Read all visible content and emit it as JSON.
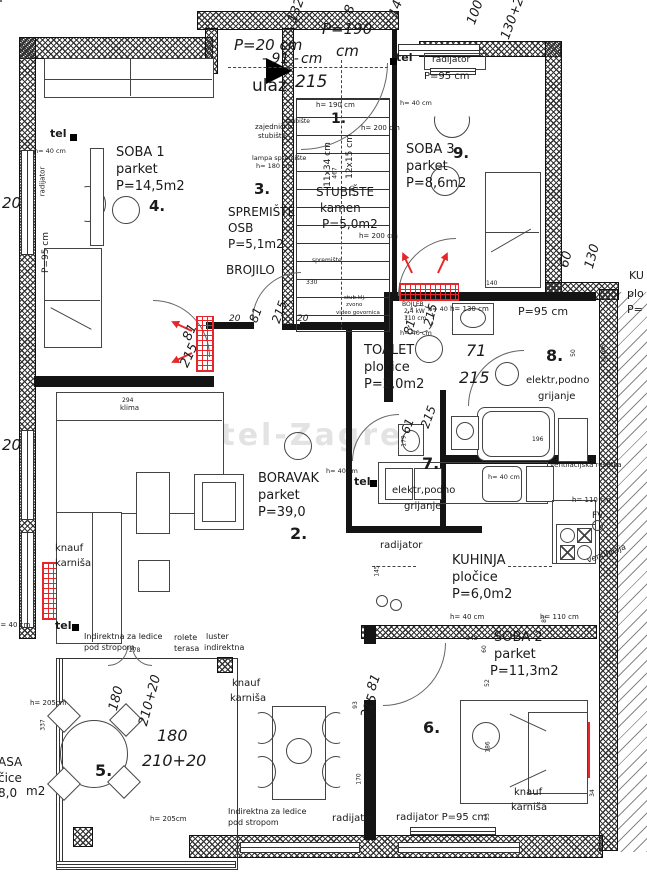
{
  "colors": {
    "radiator_red": "#e8262a",
    "wall_black": "#141414"
  },
  "watermark": {
    "text": "Kastel-Zagreb"
  },
  "labels": [
    {
      "t": "P=20 cm",
      "x": 234,
      "y": 38,
      "s": 15,
      "i": 1,
      "n": "dim-parapet-entry"
    },
    {
      "t": "P=190",
      "x": 322,
      "y": 22,
      "s": 15,
      "i": 1,
      "n": "dim-parapet"
    },
    {
      "t": "cm",
      "x": 336,
      "y": 44,
      "s": 15,
      "i": 1
    },
    {
      "t": "- 91 -",
      "x": 262,
      "y": 52,
      "s": 14,
      "i": 1,
      "n": "dim-door-width"
    },
    {
      "t": "cm",
      "x": 301,
      "y": 52,
      "s": 14,
      "i": 1
    },
    {
      "t": "ulaz",
      "x": 252,
      "y": 78,
      "s": 17,
      "n": "entrance-label"
    },
    {
      "t": "215",
      "x": 295,
      "y": 74,
      "s": 17,
      "i": 1
    },
    {
      "t": "1.",
      "x": 331,
      "y": 112,
      "s": 14,
      "b": 1,
      "n": "room-number-1"
    },
    {
      "t": "zajedničko",
      "x": 255,
      "y": 124,
      "s": 7
    },
    {
      "t": "stubište",
      "x": 258,
      "y": 133,
      "s": 7
    },
    {
      "t": "stubište",
      "x": 286,
      "y": 119,
      "s": 6
    },
    {
      "t": "h= 190 cm",
      "x": 316,
      "y": 102,
      "s": 7
    },
    {
      "t": "h= 200 cm",
      "x": 361,
      "y": 125,
      "s": 7
    },
    {
      "t": "h= 200 cm",
      "x": 359,
      "y": 233,
      "s": 7
    },
    {
      "t": "lampa spremište",
      "x": 252,
      "y": 155,
      "s": 6.5
    },
    {
      "t": "h= 180 cm",
      "x": 256,
      "y": 163,
      "s": 6.5
    },
    {
      "t": "3.",
      "x": 254,
      "y": 182,
      "s": 15,
      "b": 1,
      "n": "room-number-3"
    },
    {
      "t": "SPREMIŠTE",
      "x": 228,
      "y": 206,
      "s": 12,
      "n": "room-name-spremiste"
    },
    {
      "t": "OSB",
      "x": 228,
      "y": 222,
      "s": 12
    },
    {
      "t": "P=5,1m2",
      "x": 228,
      "y": 238,
      "s": 12
    },
    {
      "t": "BROJILO",
      "x": 226,
      "y": 264,
      "s": 12,
      "n": "meter-label"
    },
    {
      "t": "STUBIŠTE",
      "x": 316,
      "y": 186,
      "s": 12,
      "n": "room-name-stubiste"
    },
    {
      "t": "kamen",
      "x": 320,
      "y": 202,
      "s": 12
    },
    {
      "t": "P=5,0m2",
      "x": 322,
      "y": 218,
      "s": 12
    },
    {
      "t": "spremište",
      "x": 312,
      "y": 258,
      "s": 6
    },
    {
      "t": "330",
      "x": 306,
      "y": 280,
      "s": 6
    },
    {
      "t": "11x34 cm",
      "x": 306,
      "y": 160,
      "s": 9,
      "r": -90
    },
    {
      "t": "12x15 cm",
      "x": 328,
      "y": 152,
      "s": 9,
      "r": -90
    },
    {
      "t": "467",
      "x": 330,
      "y": 170,
      "s": 6,
      "r": -90
    },
    {
      "t": "170",
      "x": 348,
      "y": 188,
      "s": 6,
      "r": -90
    },
    {
      "t": "132",
      "x": 284,
      "y": 4,
      "s": 13,
      "i": 1,
      "r": -70
    },
    {
      "t": "8",
      "x": 346,
      "y": 3,
      "s": 13,
      "i": 1,
      "r": -70
    },
    {
      "t": "14",
      "x": 388,
      "y": 2,
      "s": 13,
      "i": 1,
      "r": -70
    },
    {
      "t": "100",
      "x": 463,
      "y": 6,
      "s": 13,
      "i": 1,
      "r": -70
    },
    {
      "t": "130+20",
      "x": 488,
      "y": 8,
      "s": 13,
      "i": 1,
      "r": -70
    },
    {
      "t": "tel",
      "x": 50,
      "y": 128,
      "s": 11,
      "b": 1,
      "n": "tel-label"
    },
    {
      "t": "h= 40 cm",
      "x": 34,
      "y": 148,
      "s": 6.5
    },
    {
      "t": "radijator",
      "x": 28,
      "y": 178,
      "s": 7,
      "r": -90,
      "n": "radiator-label"
    },
    {
      "t": "P=95 cm",
      "x": 26,
      "y": 248,
      "s": 9,
      "r": -90
    },
    {
      "t": "SOBA 1",
      "x": 116,
      "y": 146,
      "s": 13,
      "n": "room-name-soba1"
    },
    {
      "t": "parket",
      "x": 116,
      "y": 163,
      "s": 13
    },
    {
      "t": "P=14,5m2",
      "x": 116,
      "y": 180,
      "s": 13
    },
    {
      "t": "4.",
      "x": 149,
      "y": 199,
      "s": 15,
      "b": 1,
      "n": "room-number-4"
    },
    {
      "t": "20",
      "x": 2,
      "y": 196,
      "s": 15,
      "i": 1
    },
    {
      "t": "20",
      "x": 2,
      "y": 438,
      "s": 15,
      "i": 1
    },
    {
      "t": "tel",
      "x": 396,
      "y": 52,
      "s": 11,
      "b": 1,
      "n": "tel-label"
    },
    {
      "t": "radijator",
      "x": 432,
      "y": 56,
      "s": 9,
      "n": "radiator-label"
    },
    {
      "t": "P=95 cm",
      "x": 424,
      "y": 72,
      "s": 10
    },
    {
      "t": "h= 40 cm",
      "x": 400,
      "y": 100,
      "s": 6.5
    },
    {
      "t": "SOBA 3",
      "x": 406,
      "y": 143,
      "s": 13,
      "n": "room-name-soba3"
    },
    {
      "t": "parket",
      "x": 406,
      "y": 160,
      "s": 13
    },
    {
      "t": "P=8,6m2",
      "x": 406,
      "y": 177,
      "s": 13
    },
    {
      "t": "9.",
      "x": 453,
      "y": 146,
      "s": 15,
      "b": 1,
      "n": "room-number-9"
    },
    {
      "t": "60",
      "x": 558,
      "y": 253,
      "s": 13,
      "i": 1,
      "r": -75
    },
    {
      "t": "130",
      "x": 580,
      "y": 250,
      "s": 13,
      "i": 1,
      "r": -75
    },
    {
      "t": "140",
      "x": 486,
      "y": 281,
      "s": 6
    },
    {
      "t": "h= 40",
      "x": 428,
      "y": 306,
      "s": 6.5
    },
    {
      "t": "KU",
      "x": 629,
      "y": 270,
      "s": 11,
      "n": "cut-room-name"
    },
    {
      "t": "plo",
      "x": 627,
      "y": 288,
      "s": 11
    },
    {
      "t": "P=",
      "x": 627,
      "y": 304,
      "s": 11
    },
    {
      "t": "stub.klj.",
      "x": 344,
      "y": 296,
      "s": 5.5
    },
    {
      "t": "zvono",
      "x": 346,
      "y": 303,
      "s": 5.5
    },
    {
      "t": "video govornica",
      "x": 336,
      "y": 311,
      "s": 5.5
    },
    {
      "t": "20",
      "x": 229,
      "y": 315,
      "s": 9,
      "i": 1
    },
    {
      "t": "81",
      "x": 248,
      "y": 309,
      "s": 12,
      "i": 1,
      "r": -70
    },
    {
      "t": "215",
      "x": 268,
      "y": 306,
      "s": 12,
      "i": 1,
      "r": -70
    },
    {
      "t": "20",
      "x": 297,
      "y": 315,
      "s": 9,
      "i": 1
    },
    {
      "t": "81",
      "x": 182,
      "y": 326,
      "s": 13,
      "i": 1,
      "r": -65
    },
    {
      "t": "215",
      "x": 177,
      "y": 349,
      "s": 13,
      "i": 1,
      "r": -65
    },
    {
      "t": "TOALET",
      "x": 364,
      "y": 344,
      "s": 13,
      "n": "room-name-toalet"
    },
    {
      "t": "pločice",
      "x": 364,
      "y": 361,
      "s": 13
    },
    {
      "t": "P=2,0m2",
      "x": 364,
      "y": 378,
      "s": 13
    },
    {
      "t": "71",
      "x": 466,
      "y": 343,
      "s": 16,
      "i": 1
    },
    {
      "t": "215",
      "x": 459,
      "y": 370,
      "s": 16,
      "i": 1
    },
    {
      "t": "81",
      "x": 402,
      "y": 321,
      "s": 12,
      "i": 1,
      "r": -75
    },
    {
      "t": "215",
      "x": 419,
      "y": 309,
      "s": 12,
      "i": 1,
      "r": -75
    },
    {
      "t": "8.",
      "x": 546,
      "y": 348,
      "s": 16,
      "b": 1,
      "n": "room-number-8"
    },
    {
      "t": "50",
      "x": 570,
      "y": 350,
      "s": 6,
      "r": -90
    },
    {
      "t": "el.trlo",
      "x": 596,
      "y": 350,
      "s": 6,
      "r": -90
    },
    {
      "t": "elektr,podno",
      "x": 526,
      "y": 376,
      "s": 10
    },
    {
      "t": "grijanje",
      "x": 538,
      "y": 392,
      "s": 10
    },
    {
      "t": "BOJLER",
      "x": 402,
      "y": 302,
      "s": 6,
      "n": "boiler-label"
    },
    {
      "t": "2,4 kW",
      "x": 404,
      "y": 309,
      "s": 6
    },
    {
      "t": "110 cm",
      "x": 404,
      "y": 316,
      "s": 6
    },
    {
      "t": "h= 40 cm",
      "x": 400,
      "y": 330,
      "s": 6.5
    },
    {
      "t": "h= 130 cm",
      "x": 450,
      "y": 306,
      "s": 7
    },
    {
      "t": "P=95 cm",
      "x": 518,
      "y": 306,
      "s": 11
    },
    {
      "t": "196",
      "x": 532,
      "y": 437,
      "s": 6
    },
    {
      "t": "61",
      "x": 400,
      "y": 420,
      "s": 12,
      "i": 1,
      "r": -70
    },
    {
      "t": "215",
      "x": 417,
      "y": 411,
      "s": 12,
      "i": 1,
      "r": -70
    },
    {
      "t": "179",
      "x": 399,
      "y": 438,
      "s": 6,
      "r": -90
    },
    {
      "t": "7.",
      "x": 422,
      "y": 456,
      "s": 16,
      "b": 1,
      "n": "room-number-7"
    },
    {
      "t": "tel",
      "x": 354,
      "y": 476,
      "s": 11,
      "b": 1,
      "n": "tel-label"
    },
    {
      "t": "h= 40 cm",
      "x": 326,
      "y": 468,
      "s": 6.5
    },
    {
      "t": "elektr,podno",
      "x": 392,
      "y": 486,
      "s": 10
    },
    {
      "t": "grijanje",
      "x": 404,
      "y": 502,
      "s": 10
    },
    {
      "t": "294",
      "x": 122,
      "y": 398,
      "s": 6
    },
    {
      "t": "klima",
      "x": 120,
      "y": 405,
      "s": 7,
      "n": "ac-label"
    },
    {
      "t": "BORAVAK",
      "x": 258,
      "y": 472,
      "s": 13,
      "n": "room-name-boravak"
    },
    {
      "t": "parket",
      "x": 258,
      "y": 489,
      "s": 13
    },
    {
      "t": "P=39,0",
      "x": 258,
      "y": 506,
      "s": 13
    },
    {
      "t": "2.",
      "x": 290,
      "y": 526,
      "s": 16,
      "b": 1,
      "n": "room-number-2"
    },
    {
      "t": "ventilacijska rešetka",
      "x": 550,
      "y": 462,
      "s": 7
    },
    {
      "t": "FV",
      "x": 592,
      "y": 512,
      "s": 9
    },
    {
      "t": "h= 110 cm",
      "x": 572,
      "y": 497,
      "s": 7
    },
    {
      "t": "radijator",
      "x": 380,
      "y": 541,
      "s": 10,
      "n": "radiator-label"
    },
    {
      "t": "KUHINJA",
      "x": 452,
      "y": 554,
      "s": 13,
      "n": "room-name-kuhinja"
    },
    {
      "t": "pločice",
      "x": 452,
      "y": 571,
      "s": 13
    },
    {
      "t": "P=6,0m2",
      "x": 452,
      "y": 588,
      "s": 13
    },
    {
      "t": "ventilacija",
      "x": 586,
      "y": 550,
      "s": 8,
      "r": -20
    },
    {
      "t": "h= 40 cm",
      "x": 450,
      "y": 614,
      "s": 7
    },
    {
      "t": "h= 110 cm",
      "x": 540,
      "y": 614,
      "s": 7
    },
    {
      "t": "h= 40 cm",
      "x": 488,
      "y": 474,
      "s": 6.5
    },
    {
      "t": "145",
      "x": 372,
      "y": 568,
      "s": 6,
      "r": -90
    },
    {
      "t": "knauf",
      "x": 55,
      "y": 544,
      "s": 10
    },
    {
      "t": "karniša",
      "x": 55,
      "y": 559,
      "s": 10
    },
    {
      "t": "tel",
      "x": 55,
      "y": 620,
      "s": 11,
      "b": 1,
      "n": "tel-label"
    },
    {
      "t": "h= 40 cm",
      "x": -4,
      "y": 622,
      "s": 7
    },
    {
      "t": "Indirektna za ledice",
      "x": 84,
      "y": 633,
      "s": 8
    },
    {
      "t": "pod stropom",
      "x": 84,
      "y": 644,
      "s": 8
    },
    {
      "t": "278",
      "x": 129,
      "y": 648,
      "s": 6
    },
    {
      "t": "rolete",
      "x": 174,
      "y": 634,
      "s": 8
    },
    {
      "t": "terasa",
      "x": 174,
      "y": 645,
      "s": 8
    },
    {
      "t": "luster",
      "x": 206,
      "y": 633,
      "s": 8
    },
    {
      "t": "indirektna",
      "x": 204,
      "y": 644,
      "s": 8
    },
    {
      "t": "h= 205cm",
      "x": 30,
      "y": 700,
      "s": 7
    },
    {
      "t": "337",
      "x": 38,
      "y": 722,
      "s": 6,
      "r": -90
    },
    {
      "t": "180",
      "x": 104,
      "y": 692,
      "s": 13,
      "i": 1,
      "r": -75
    },
    {
      "t": "210+20",
      "x": 124,
      "y": 694,
      "s": 13,
      "i": 1,
      "r": -75
    },
    {
      "t": "180",
      "x": 157,
      "y": 728,
      "s": 16,
      "i": 1
    },
    {
      "t": "210+20",
      "x": 142,
      "y": 753,
      "s": 16,
      "i": 1
    },
    {
      "t": "5.",
      "x": 95,
      "y": 763,
      "s": 16,
      "b": 1,
      "n": "room-number-5"
    },
    {
      "t": "ASA",
      "x": -2,
      "y": 756,
      "s": 12,
      "n": "cut-room-name-terasa"
    },
    {
      "t": "čice",
      "x": -2,
      "y": 772,
      "s": 12
    },
    {
      "t": "8,0",
      "x": -2,
      "y": 787,
      "s": 12
    },
    {
      "t": "m2",
      "x": 26,
      "y": 785,
      "s": 12
    },
    {
      "t": "h= 205cm",
      "x": 150,
      "y": 816,
      "s": 7
    },
    {
      "t": "knauf",
      "x": 232,
      "y": 679,
      "s": 10
    },
    {
      "t": "karniša",
      "x": 230,
      "y": 694,
      "s": 10
    },
    {
      "t": "Indirektna za ledice",
      "x": 228,
      "y": 808,
      "s": 8
    },
    {
      "t": "pod stropom",
      "x": 228,
      "y": 819,
      "s": 8
    },
    {
      "t": "radijator",
      "x": 332,
      "y": 814,
      "s": 10,
      "n": "radiator-label"
    },
    {
      "t": "radijator P=95 cm",
      "x": 396,
      "y": 813,
      "s": 10,
      "n": "radiator-label"
    },
    {
      "t": "81",
      "x": 366,
      "y": 676,
      "s": 13,
      "i": 1,
      "r": -70
    },
    {
      "t": "215",
      "x": 357,
      "y": 700,
      "s": 13,
      "i": 1,
      "r": -70
    },
    {
      "t": "93",
      "x": 352,
      "y": 702,
      "s": 6,
      "r": -90
    },
    {
      "t": "170",
      "x": 354,
      "y": 776,
      "s": 6,
      "r": -90
    },
    {
      "t": "343",
      "x": 466,
      "y": 636,
      "s": 6
    },
    {
      "t": "60",
      "x": 481,
      "y": 646,
      "s": 6,
      "r": -90
    },
    {
      "t": "81",
      "x": 541,
      "y": 616,
      "s": 6,
      "r": -90
    },
    {
      "t": "SOBA 2",
      "x": 494,
      "y": 631,
      "s": 13,
      "n": "room-name-soba2"
    },
    {
      "t": "parket",
      "x": 494,
      "y": 648,
      "s": 13
    },
    {
      "t": "P=11,3m2",
      "x": 490,
      "y": 665,
      "s": 13
    },
    {
      "t": "6.",
      "x": 423,
      "y": 720,
      "s": 16,
      "b": 1,
      "n": "room-number-6"
    },
    {
      "t": "52",
      "x": 484,
      "y": 680,
      "s": 6,
      "r": -90
    },
    {
      "t": "186",
      "x": 483,
      "y": 744,
      "s": 6,
      "r": -90
    },
    {
      "t": "53",
      "x": 484,
      "y": 814,
      "s": 6,
      "r": -90
    },
    {
      "t": "34",
      "x": 589,
      "y": 790,
      "s": 6,
      "r": -90
    },
    {
      "t": "knauf",
      "x": 514,
      "y": 788,
      "s": 10
    },
    {
      "t": "karniša",
      "x": 511,
      "y": 803,
      "s": 10
    }
  ]
}
